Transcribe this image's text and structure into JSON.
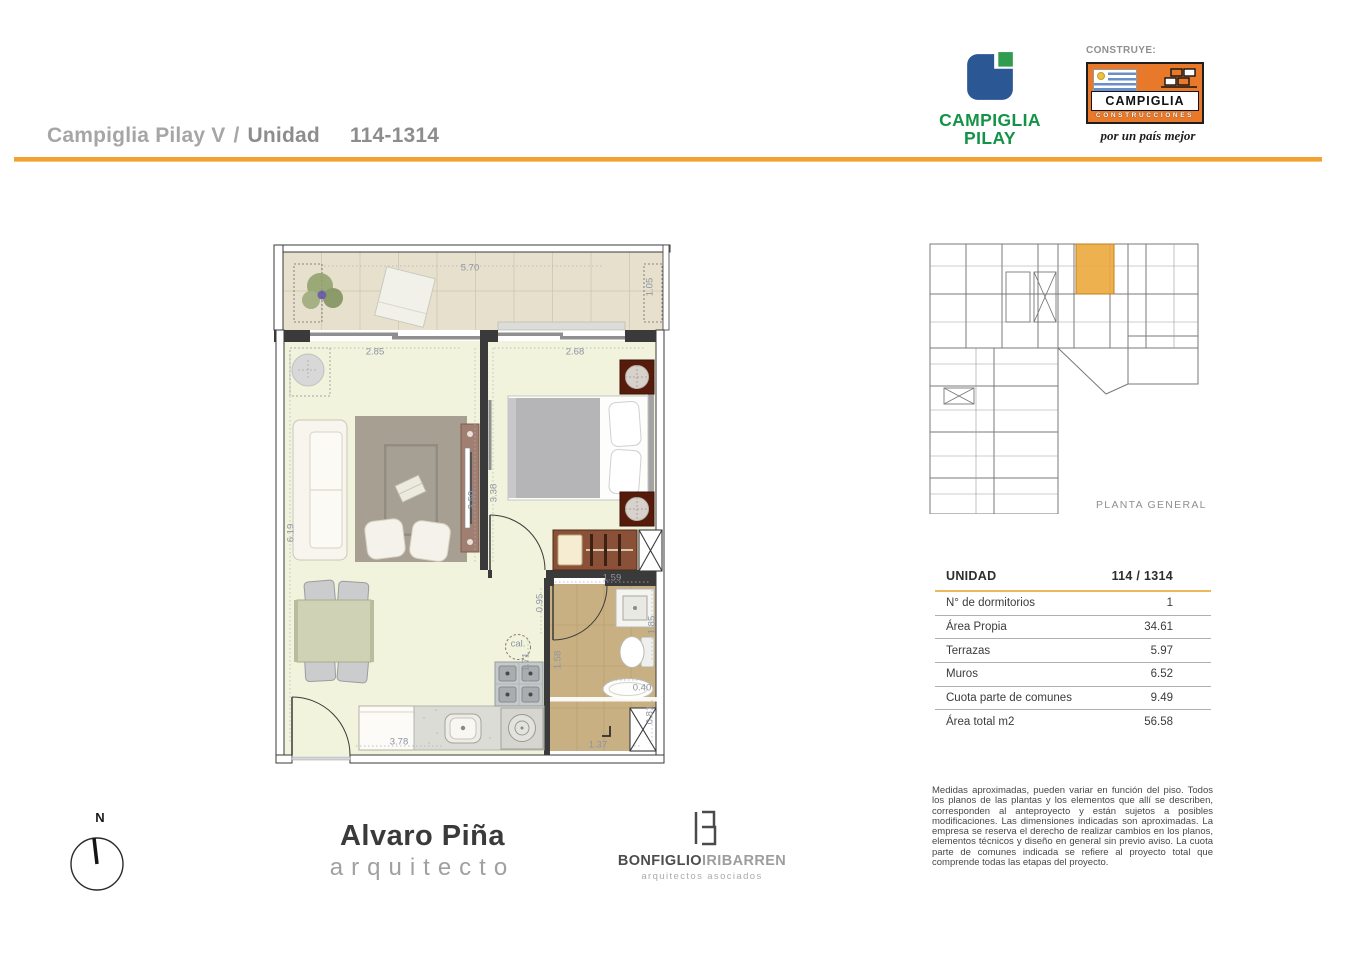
{
  "header": {
    "project": "Campiglia Pilay V",
    "separator": "/",
    "unit_label": "Unidad",
    "unit_number": "114-1314"
  },
  "logos": {
    "pilay": {
      "line1": "CAMPIGLIA",
      "line2": "PILAY",
      "green": "#149347",
      "blue": "#2B5795"
    },
    "construye_label": "CONSTRUYE:",
    "construcciones": {
      "name": "CAMPIGLIA",
      "subtitle": "CONSTRUCCIONES",
      "tagline": "por un país mejor",
      "orange": "#E8792A"
    }
  },
  "key_plan": {
    "caption": "PLANTA GENERAL",
    "highlight_color": "#ECA83D"
  },
  "unit_table": {
    "header": {
      "label": "UNIDAD",
      "value": "114 / 1314"
    },
    "rows": [
      {
        "label": "N° de dormitorios",
        "value": "1"
      },
      {
        "label": "Área Propia",
        "value": "34.61"
      },
      {
        "label": "Terrazas",
        "value": "5.97"
      },
      {
        "label": "Muros",
        "value": "6.52"
      },
      {
        "label": "Cuota parte de comunes",
        "value": "9.49"
      },
      {
        "label": "Área total m2",
        "value": "56.58"
      }
    ]
  },
  "disclaimer": "Medidas aproximadas, pueden variar en función del piso. Todos los planos de las plantas y los elementos que allí se describen, corresponden al anteproyecto y están sujetos a posibles modificaciones. Las dimensiones indicadas son aproximadas. La empresa se reserva el derecho de realizar cambios en los planos, elementos técnicos y diseño en general sin previo aviso. La cuota parte de comunes indicada se refiere al proyecto total que comprende todas las etapas del proyecto.",
  "compass": {
    "north_label": "N"
  },
  "architect": {
    "name": "Alvaro Piña",
    "title": "arquitecto"
  },
  "studio": {
    "name_dark": "BONFIGLIO",
    "name_light": "IRIBARREN",
    "subtitle": "arquitectos asociados"
  },
  "floorplan": {
    "accent_orange": "#F2A233",
    "dimensions": [
      {
        "label": "5.70",
        "x": 206,
        "y": 30,
        "rot": 0
      },
      {
        "label": "1.05",
        "x": 386,
        "y": 49,
        "rot": 1
      },
      {
        "label": "2.85",
        "x": 111,
        "y": 114,
        "rot": 0
      },
      {
        "label": "2.68",
        "x": 311,
        "y": 114,
        "rot": 0
      },
      {
        "label": "6.19",
        "x": 27,
        "y": 295,
        "rot": 1
      },
      {
        "label": "3.50",
        "x": 208,
        "y": 262,
        "rot": 1
      },
      {
        "label": "3.38",
        "x": 230,
        "y": 255,
        "rot": 1
      },
      {
        "label": "1.59",
        "x": 348,
        "y": 340,
        "rot": 0
      },
      {
        "label": "0.95",
        "x": 276,
        "y": 365,
        "rot": 1
      },
      {
        "label": "1.85",
        "x": 388,
        "y": 387,
        "rot": 1
      },
      {
        "label": "1.58",
        "x": 294,
        "y": 422,
        "rot": 1
      },
      {
        "label": "1.71",
        "x": 262,
        "y": 424,
        "rot": 1
      },
      {
        "label": "0.40",
        "x": 378,
        "y": 450,
        "rot": 0
      },
      {
        "label": "0.81",
        "x": 386,
        "y": 477,
        "rot": 1
      },
      {
        "label": "1.37",
        "x": 334,
        "y": 507,
        "rot": 0
      },
      {
        "label": "3.78",
        "x": 135,
        "y": 504,
        "rot": 0
      },
      {
        "label": "cal.",
        "x": 254,
        "y": 406,
        "rot": 0
      }
    ]
  }
}
